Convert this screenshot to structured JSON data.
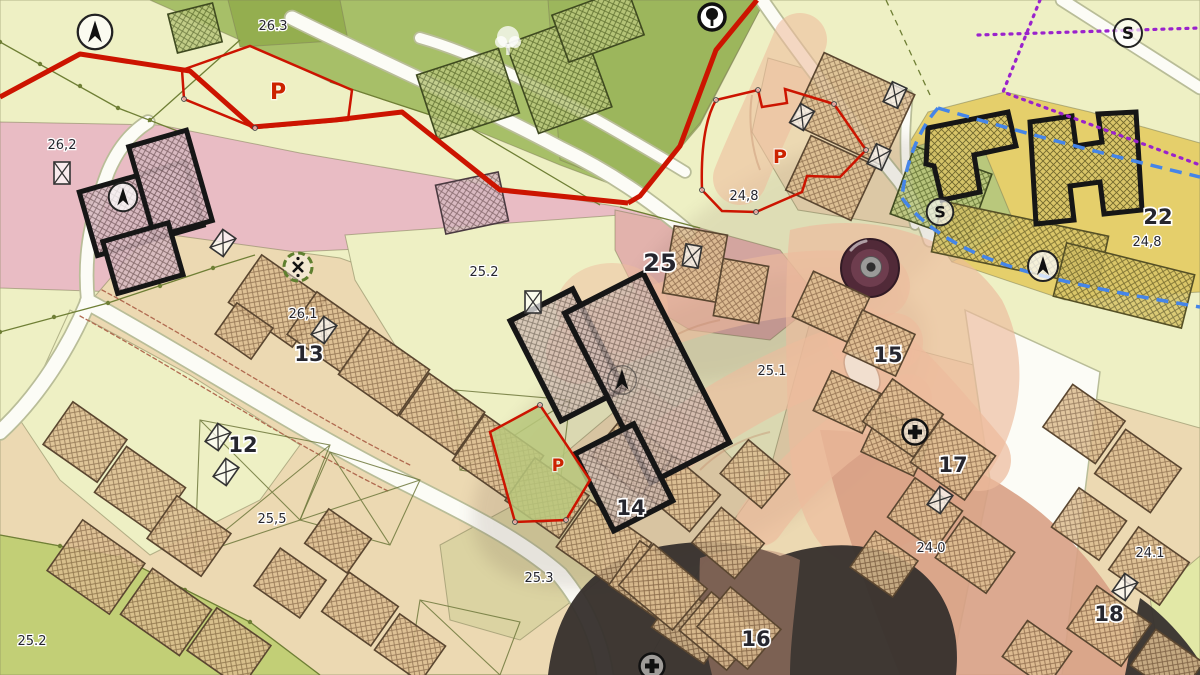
{
  "map": {
    "kind": "cadastral-zoning-map",
    "parcel_labels": [
      {
        "t": "26.3",
        "x": 273,
        "y": 30,
        "s": 13,
        "b": 0
      },
      {
        "t": "26,2",
        "x": 62,
        "y": 149,
        "s": 13,
        "b": 0
      },
      {
        "t": "26,1",
        "x": 303,
        "y": 318,
        "s": 13,
        "b": 0
      },
      {
        "t": "13",
        "x": 309,
        "y": 361,
        "s": 21,
        "b": 1
      },
      {
        "t": "12",
        "x": 243,
        "y": 452,
        "s": 21,
        "b": 1
      },
      {
        "t": "25,5",
        "x": 272,
        "y": 523,
        "s": 13,
        "b": 0
      },
      {
        "t": "25.2",
        "x": 32,
        "y": 645,
        "s": 13,
        "b": 0
      },
      {
        "t": "25.2",
        "x": 484,
        "y": 276,
        "s": 13,
        "b": 0
      },
      {
        "t": "25.3",
        "x": 539,
        "y": 582,
        "s": 13,
        "b": 0
      },
      {
        "t": "25",
        "x": 660,
        "y": 271,
        "s": 24,
        "b": 1
      },
      {
        "t": "25.1",
        "x": 772,
        "y": 375,
        "s": 13,
        "b": 0
      },
      {
        "t": "24,8",
        "x": 744,
        "y": 200,
        "s": 13,
        "b": 0
      },
      {
        "t": "24,8",
        "x": 1147,
        "y": 246,
        "s": 13,
        "b": 0
      },
      {
        "t": "22",
        "x": 1158,
        "y": 224,
        "s": 21,
        "b": 1
      },
      {
        "t": "15",
        "x": 888,
        "y": 362,
        "s": 21,
        "b": 1
      },
      {
        "t": "14",
        "x": 631,
        "y": 515,
        "s": 21,
        "b": 1
      },
      {
        "t": "16",
        "x": 756,
        "y": 646,
        "s": 21,
        "b": 1
      },
      {
        "t": "17",
        "x": 953,
        "y": 472,
        "s": 21,
        "b": 1
      },
      {
        "t": "24.0",
        "x": 931,
        "y": 552,
        "s": 13,
        "b": 0
      },
      {
        "t": "24.1",
        "x": 1150,
        "y": 557,
        "s": 13,
        "b": 0
      },
      {
        "t": "18",
        "x": 1109,
        "y": 621,
        "s": 21,
        "b": 1
      }
    ],
    "p_labels": [
      {
        "t": "P",
        "x": 278,
        "y": 99,
        "s": 22
      },
      {
        "t": "P",
        "x": 780,
        "y": 163,
        "s": 19
      },
      {
        "t": "P",
        "x": 558,
        "y": 471,
        "s": 17
      }
    ],
    "symbols": [
      {
        "type": "north-circle",
        "x": 95,
        "y": 32,
        "sc": 1.15
      },
      {
        "type": "north-circle",
        "x": 123,
        "y": 197,
        "sc": 0.95
      },
      {
        "type": "north-plain",
        "x": 622,
        "y": 380,
        "sc": 1.1
      },
      {
        "type": "north-circle",
        "x": 1043,
        "y": 266,
        "sc": 1.0
      },
      {
        "type": "s-circle",
        "x": 1128,
        "y": 33,
        "sc": 1.0
      },
      {
        "type": "s-circle",
        "x": 940,
        "y": 212,
        "sc": 0.95
      },
      {
        "type": "tree-light",
        "x": 508,
        "y": 42,
        "sc": 1.0
      },
      {
        "type": "tree-dark",
        "x": 712,
        "y": 17,
        "sc": 1.0
      },
      {
        "type": "crossed-circle",
        "x": 298,
        "y": 267,
        "sc": 1.0
      },
      {
        "type": "plus-circle",
        "x": 915,
        "y": 432,
        "sc": 1.0
      },
      {
        "type": "plus-circle",
        "x": 652,
        "y": 666,
        "sc": 1.0
      },
      {
        "type": "rect-x",
        "x": 62,
        "y": 173,
        "r": 0
      },
      {
        "type": "rect-x",
        "x": 223,
        "y": 243,
        "r": 35
      },
      {
        "type": "rect-x",
        "x": 324,
        "y": 330,
        "r": 35
      },
      {
        "type": "rect-x",
        "x": 533,
        "y": 302,
        "r": 0
      },
      {
        "type": "rect-x",
        "x": 692,
        "y": 256,
        "r": 10
      },
      {
        "type": "rect-x",
        "x": 895,
        "y": 95,
        "r": 25
      },
      {
        "type": "rect-x",
        "x": 879,
        "y": 157,
        "r": 25
      },
      {
        "type": "rect-x",
        "x": 802,
        "y": 117,
        "r": 30
      },
      {
        "type": "rect-x",
        "x": 218,
        "y": 437,
        "r": 35
      },
      {
        "type": "rect-x",
        "x": 226,
        "y": 472,
        "r": 35
      },
      {
        "type": "rect-x",
        "x": 940,
        "y": 500,
        "r": 35
      },
      {
        "type": "rect-x",
        "x": 1125,
        "y": 587,
        "r": 35
      }
    ],
    "colors": {
      "base": "#eef0c4",
      "park": "#a7bf68",
      "park_dark": "#94ae4f",
      "park_dark2": "#9cb65c",
      "pink": "#e9bcc4",
      "pink_center": "#e2b2ac",
      "tan": "#ecd9b2",
      "yellow": "#e5cf6b",
      "olive": "#c2cf76",
      "olive_dark": "#b9c87c",
      "sand": "#dbd3a2",
      "pale_corner": "#e2e8a6",
      "road": "#fcfcf6",
      "road_casing": "#b9bd98",
      "red": "#cc1400",
      "p_label": "#cc2200",
      "blue_dash": "#4585e8",
      "purple_dot": "#9a22cc",
      "line_green": "#6f7f35",
      "label": "#26262e",
      "black": "#161616",
      "skin": "#edbb9d",
      "skin_deep": "#d8a085",
      "nail": "#f2e3d5",
      "sleeve": "#37312e",
      "pen_outer": "#4b2434",
      "pen_mid": "#6e3d4e",
      "pen_metal": "#9a9a98"
    }
  }
}
